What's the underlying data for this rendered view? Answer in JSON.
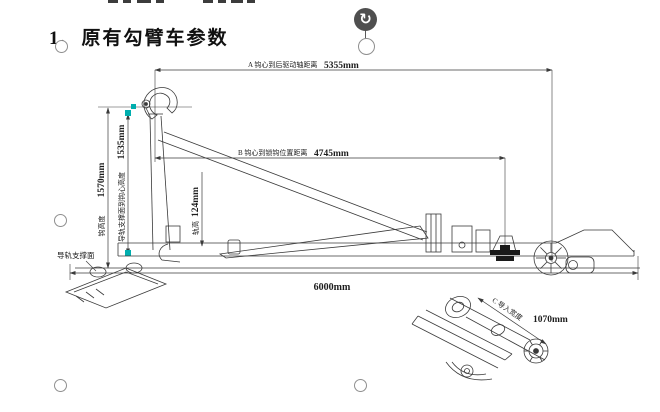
{
  "document": {
    "heading": "1、原有勾臂车参数"
  },
  "drawing": {
    "dim_a_label": "A 钩心到后驱动轴距离",
    "dim_a_value": "5355mm",
    "dim_b_label": "B 钩心到锁钩位置距离",
    "dim_b_value": "4745mm",
    "dim_total_height_value": "1570mm",
    "dim_total_height_label": "钩高度",
    "dim_rail_height_value": "1535mm",
    "dim_rail_height_label": "导轨支撑面到钩心高度",
    "dim_rail_section_value": "124mm",
    "dim_rail_section_label": "轨高",
    "dim_length_value": "6000mm",
    "dim_c_label": "C 导入宽度",
    "dim_c_value": "1070mm",
    "rail_support_label": "导轨支撑面"
  },
  "selection": {
    "rotate_icon": "↻"
  },
  "colors": {
    "line": "#3a3a3a",
    "grip": "#00aeae",
    "handle_border": "#8f8f8f",
    "rotate_handle_bg": "#4f4f4f"
  }
}
